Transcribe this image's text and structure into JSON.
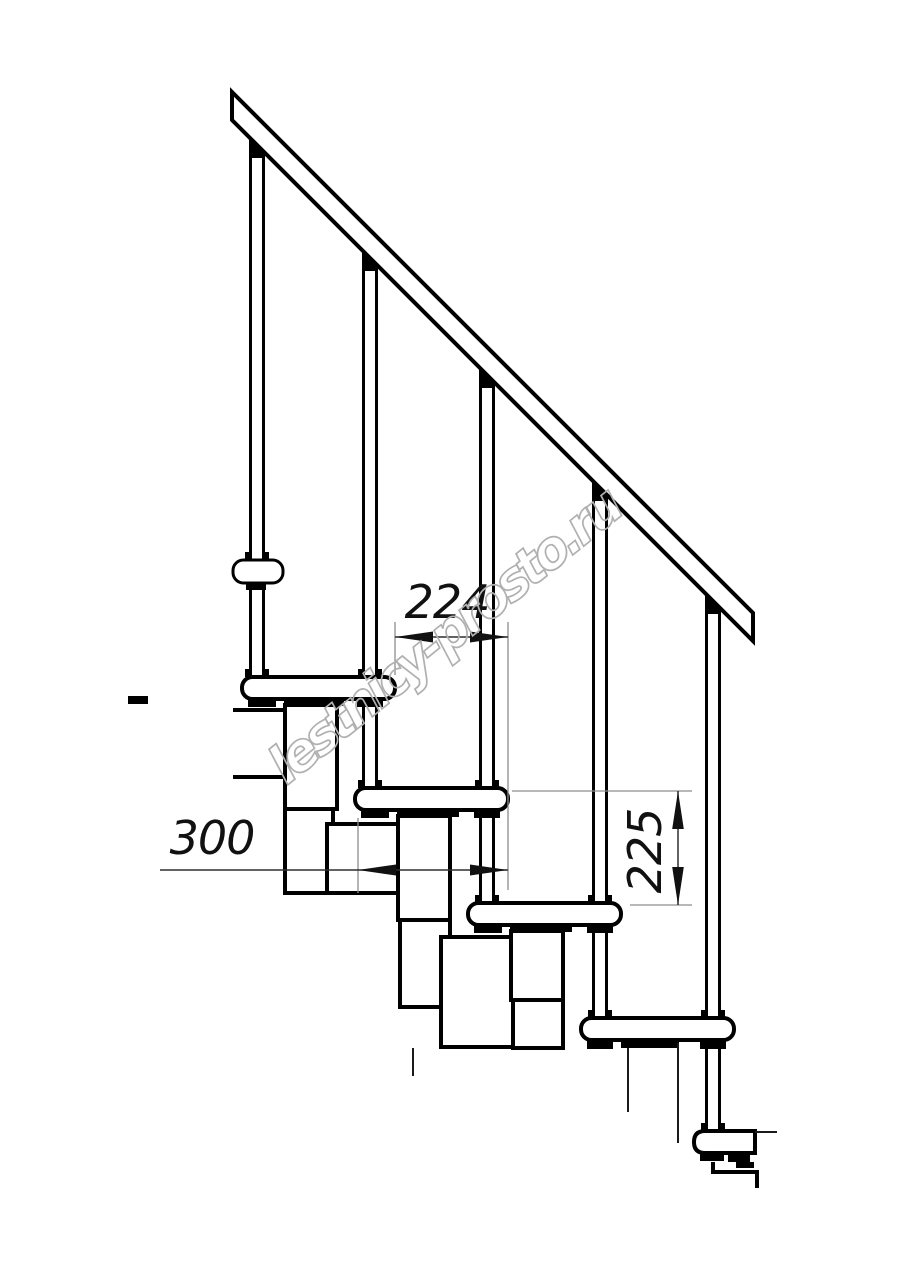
{
  "drawing": {
    "type": "modular-staircase-side-view",
    "watermark": "lestnicy-prosto.ru",
    "dimensions": {
      "tread_run": "224",
      "tread_depth": "300",
      "step_rise": "225"
    },
    "counts": {
      "balusters": 5,
      "treads": 5
    },
    "colors": {
      "line": "#000000",
      "dim_line": "#2f2f2f",
      "extension_line": "#8d8d8d",
      "watermark": "#b0b0b0",
      "background": "#ffffff"
    }
  }
}
